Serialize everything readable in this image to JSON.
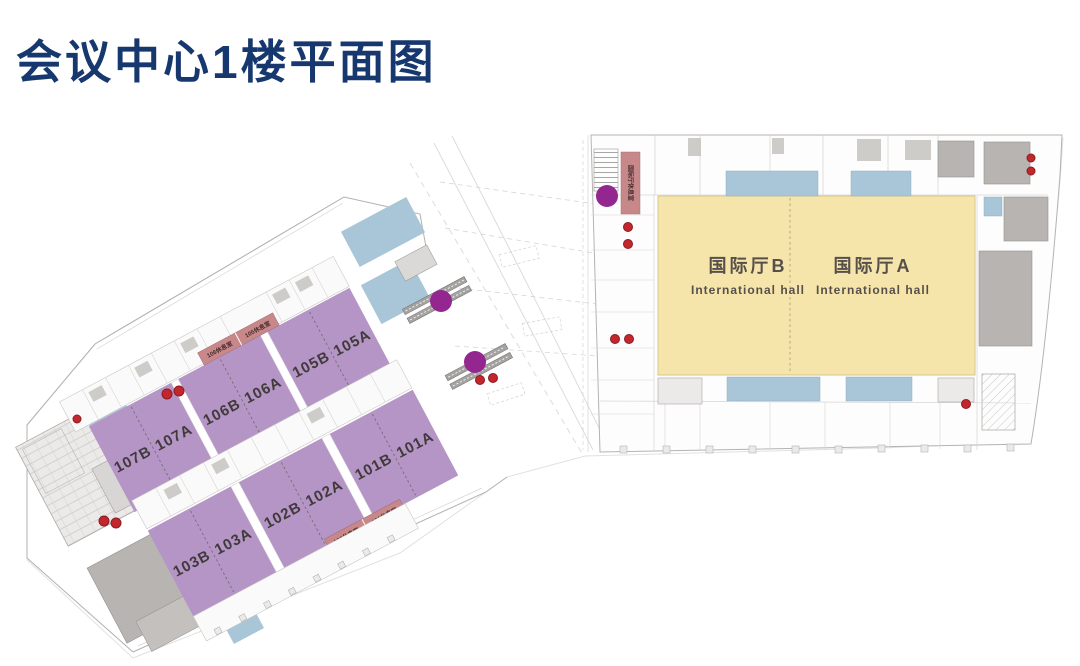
{
  "title": "会议中心1楼平面图",
  "plan": {
    "halls": {
      "b": {
        "name": "国际厅B",
        "subtitle": "International hall"
      },
      "a": {
        "name": "国际厅A",
        "subtitle": "International hall"
      }
    },
    "rooms_upper": [
      "107B",
      "107A",
      "106B",
      "106A",
      "105B",
      "105A"
    ],
    "rooms_lower": [
      "103B",
      "103A",
      "102B",
      "102A",
      "101B",
      "101A"
    ],
    "lounges": {
      "upper_left": "106休息室",
      "upper_right": "105休息室",
      "lower_left": "102休息室",
      "lower_right": "101休息室",
      "hall": "国际厅休息室"
    },
    "colors": {
      "title": "#17386e",
      "meeting_room": "#b594c6",
      "hall": "#f5e5ab",
      "prefunction_blue": "#a9c6d8",
      "lounge_pink": "#c8888a",
      "escalator_marker": "#93278f",
      "fire_marker": "#c1272d"
    }
  }
}
